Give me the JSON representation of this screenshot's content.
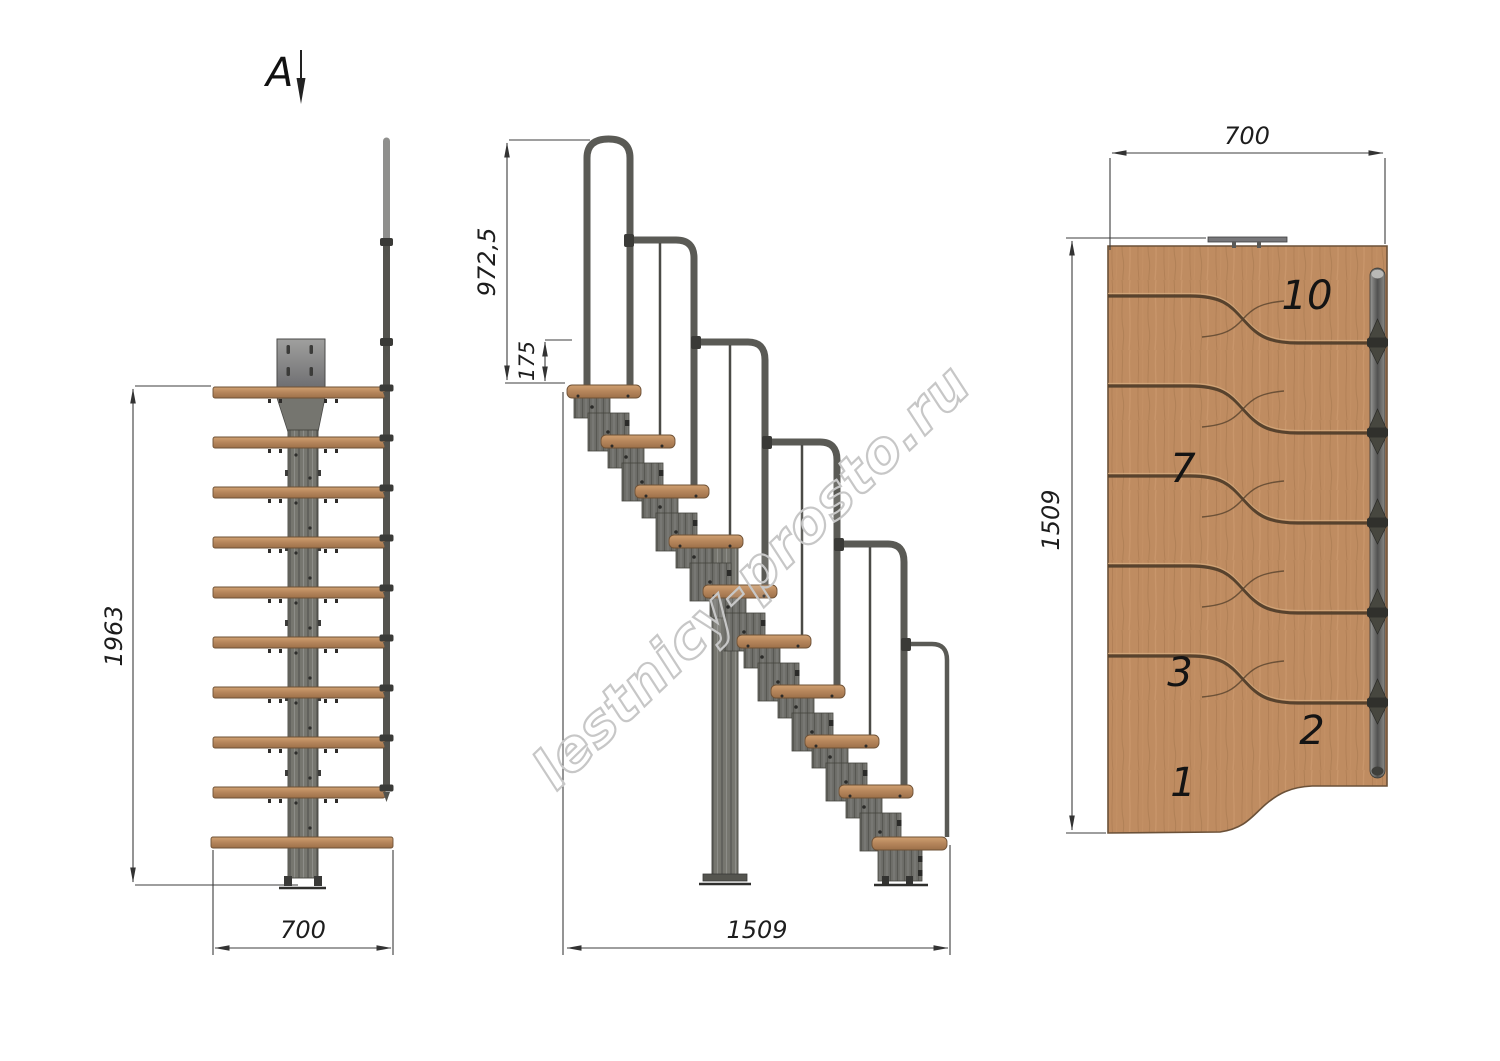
{
  "watermark": {
    "text": "lestnicy-prosto.ru"
  },
  "section_label": {
    "letter": "A"
  },
  "front_view": {
    "dim_height_mm": "1963",
    "dim_width_mm": "700"
  },
  "side_view": {
    "dim_handrail_height_mm": "972,5",
    "dim_rail_offset_mm": "175",
    "dim_run_length_mm": "1509"
  },
  "plan_view": {
    "dim_width_mm": "700",
    "dim_depth_mm": "1509",
    "tread_numbers": [
      "10",
      "7",
      "3",
      "2",
      "1"
    ]
  },
  "colors": {
    "wood": "#bf8c61",
    "wood_edge": "#6e5136",
    "metal": "#6f6f6a",
    "metal_dark": "#3a3a37",
    "dimension_line": "#3c3c3c",
    "watermark_outline": "#c7c7c7"
  }
}
